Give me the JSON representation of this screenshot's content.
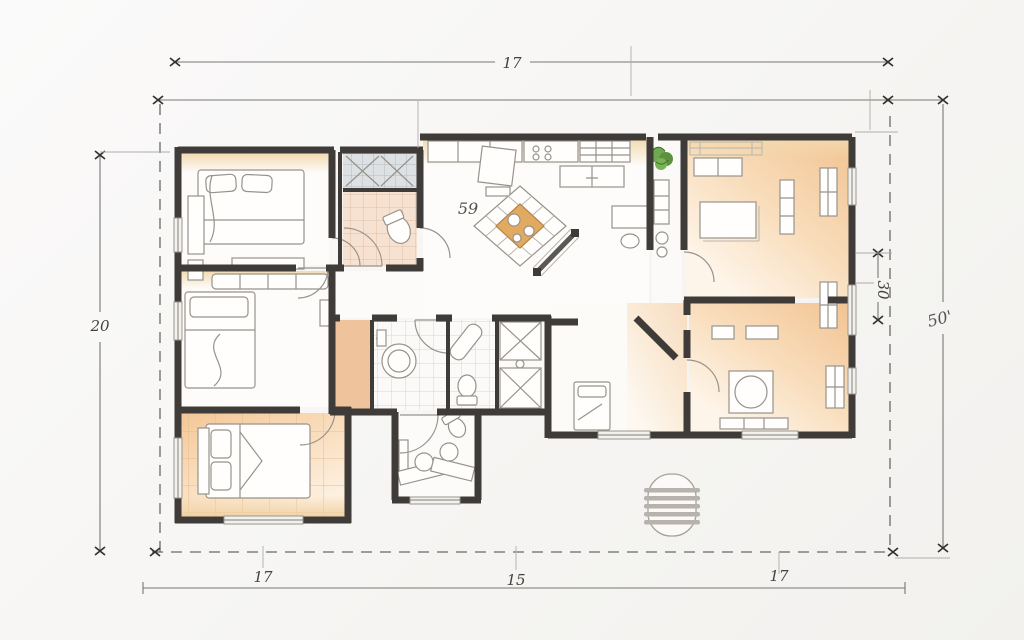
{
  "dimensions": {
    "top_width": "17",
    "outer_left_height": "20",
    "right_wing_depth": "30",
    "outer_right_height": "50'",
    "kitchen_area_label": "59",
    "bottom_segment_left": "17",
    "bottom_segment_middle": "15",
    "bottom_segment_right": "17"
  },
  "colors": {
    "wall": "#3e3b38",
    "sketch": "#97938c",
    "dim": "#7a7773",
    "plant": "#6fa84f",
    "island": "#e2aa60",
    "paper": "#f8f7f5"
  }
}
